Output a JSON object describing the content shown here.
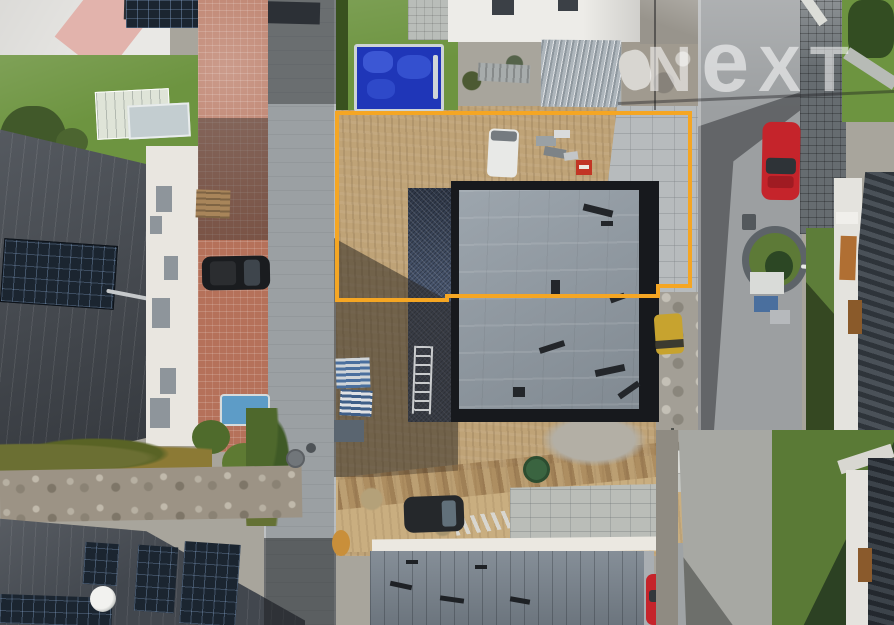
{
  "watermark": {
    "brand": "NEXT",
    "display": {
      "n": "N",
      "e": "e",
      "xt": "XT",
      "caret": "^"
    }
  },
  "colors": {
    "boundary": "#F5A623",
    "sand": "#BFA377",
    "membrane": "#8F99A2",
    "buildingFrame": "#17191D",
    "roofDark": "#42474E",
    "roofBottom": "#7B858F",
    "solar": "#1B2530",
    "grass": "#6D9440",
    "terracotta": "#B5715A",
    "streetGray": "#9BA0A3",
    "asphalt": "#9C9FA1",
    "redCar": "#C5242B",
    "darkCar": "#1A1C1F",
    "watermark": "rgba(255,255,255,0.55)"
  },
  "scene": {
    "type": "aerial-drone-photograph",
    "features": [
      "construction plot outlined in yellow",
      "building under construction with gray membrane roof",
      "houses with dark standing-seam roofs and solar panels",
      "streets with parked cars (black SUV, two red cars)",
      "blue swimming pool",
      "lawns, hedges and paved driveways"
    ]
  }
}
